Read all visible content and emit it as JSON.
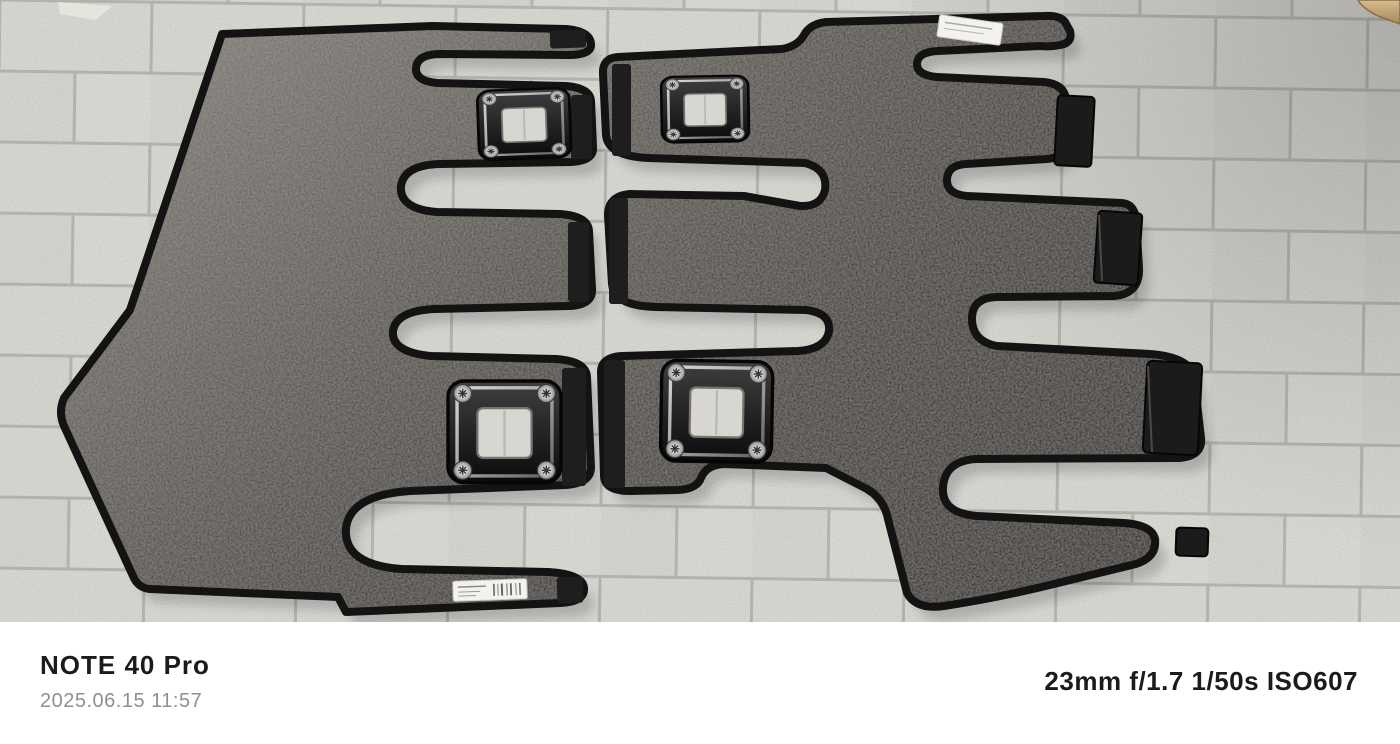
{
  "photo": {
    "kind": "camera photograph",
    "subject": "Two-piece rear-row car floor carpet mat set with black edge binding laid out on a speckled gray tile floor",
    "floor": "light gray speckled ceramic tiles in running-bond pattern",
    "mats": [
      {
        "name": "left mat",
        "grommets": 2,
        "sticker": "white barcode label, text illegible"
      },
      {
        "name": "right mat",
        "grommets": 2,
        "sticker": "small white label, text illegible",
        "tabs": "stepped velcro tab flaps along right edge"
      }
    ],
    "corner_object": "tan wooden object edge at top-right corner"
  },
  "watermark": {
    "device": "NOTE 40 Pro",
    "datetime": "2025.06.15 11:57",
    "exif": "23mm f/1.7 1/50s ISO607"
  },
  "colors": {
    "band_bg": "#ffffff",
    "text_primary": "#1b1b1b",
    "text_secondary": "#8f8f8f",
    "tile": "#dad8d3",
    "grout": "#b7b5af",
    "carpet_left_light": "#7b7772",
    "carpet_left_dark": "#3f3c39",
    "carpet_right_light": "#5f5b57",
    "carpet_right_dark": "#332f2d",
    "binding": "#131313",
    "sticker": "#f3f2ee",
    "wood": "#c2a87c"
  }
}
